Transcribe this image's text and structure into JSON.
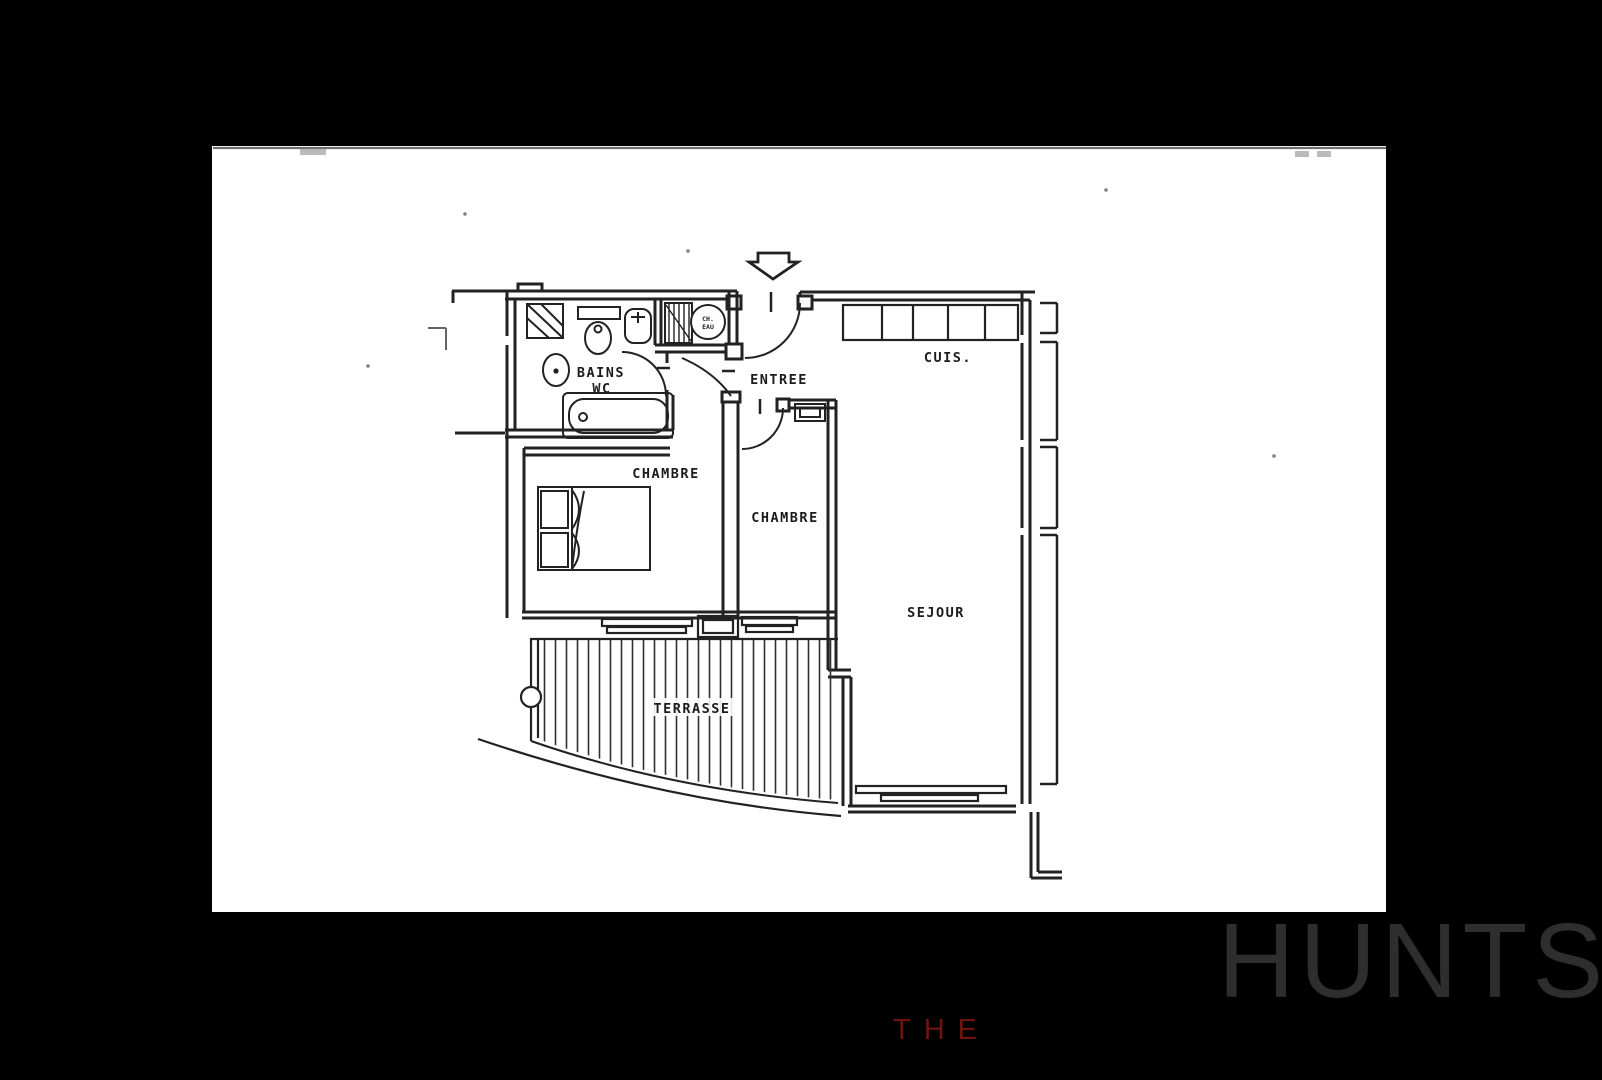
{
  "canvas": {
    "background": "#000000",
    "width": 1602,
    "height": 1080
  },
  "floorplan": {
    "kind": "apartment-floor-plan",
    "language": "French",
    "paper_color": "#ffffff",
    "ink_color": "#222222",
    "labels": {
      "bathroom_line1": "BAINS",
      "bathroom_line2": "WC",
      "water_heater_line1": "CH.",
      "water_heater_line2": "EAU",
      "entrance": "ENTREE",
      "kitchen": "CUIS.",
      "bedroom_1": "CHAMBRE",
      "bedroom_2": "CHAMBRE",
      "living_room": "SEJOUR",
      "terrace": "TERRASSE"
    },
    "entrance_arrow_direction": "down"
  },
  "watermark": {
    "the": "THE",
    "the_color": "#6e1410",
    "brand": "HUNTS",
    "brand_color": "#2e2e2e"
  }
}
